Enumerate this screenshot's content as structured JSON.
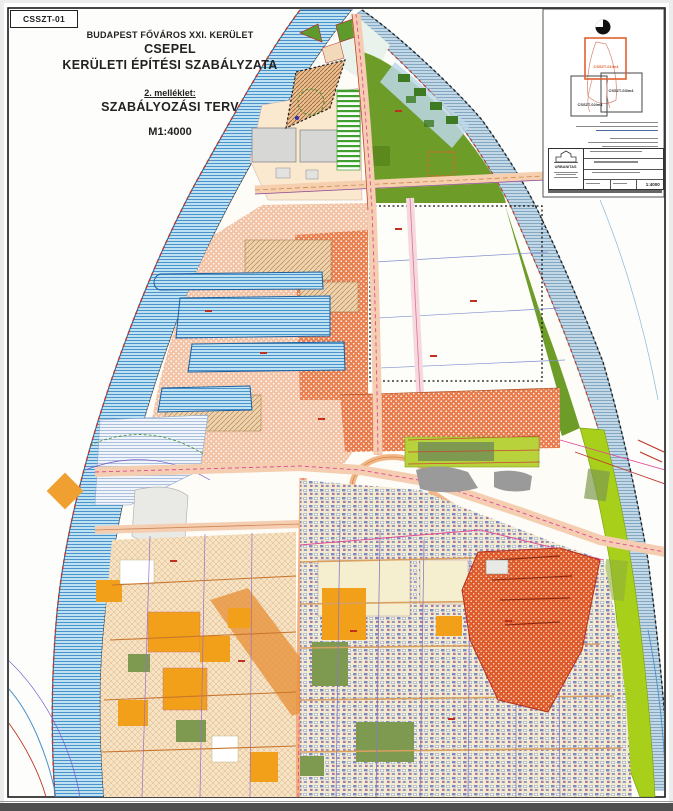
{
  "page": {
    "sheet_label": "CSSZT-01"
  },
  "title_block": {
    "line1": "BUDAPEST FŐVÁROS XXI. KERÜLET",
    "line2": "CSEPEL",
    "line3": "KERÜLETI ÉPÍTÉSI SZABÁLYZATA",
    "annex": "2. melléklet:",
    "plan_name": "SZABÁLYOZÁSI TERV",
    "scale": "M1:4000"
  },
  "index_map": {
    "sheets": [
      {
        "label": "CSSZT-01/m4",
        "active": true
      },
      {
        "label": "CSSZT-02/m4",
        "active": false
      },
      {
        "label": "CSSZT-03/m4",
        "active": false
      }
    ]
  },
  "stamp": {
    "firm": "URBANITAS",
    "drawing_scale": "1:4000"
  },
  "colors": {
    "river_fill": "#bfe2f2",
    "river_line": "#2e7fc2",
    "shore_dash": "#c03828",
    "green_zone": "#6d9d28",
    "lime_band": "#a8cf1a",
    "industrial_orange": "#e87c4c",
    "industrial_red": "#dd5a2a",
    "salmon_zone": "#f3c3a6",
    "residential_tan": "#f6e3c4",
    "index_active": "#e06030"
  }
}
